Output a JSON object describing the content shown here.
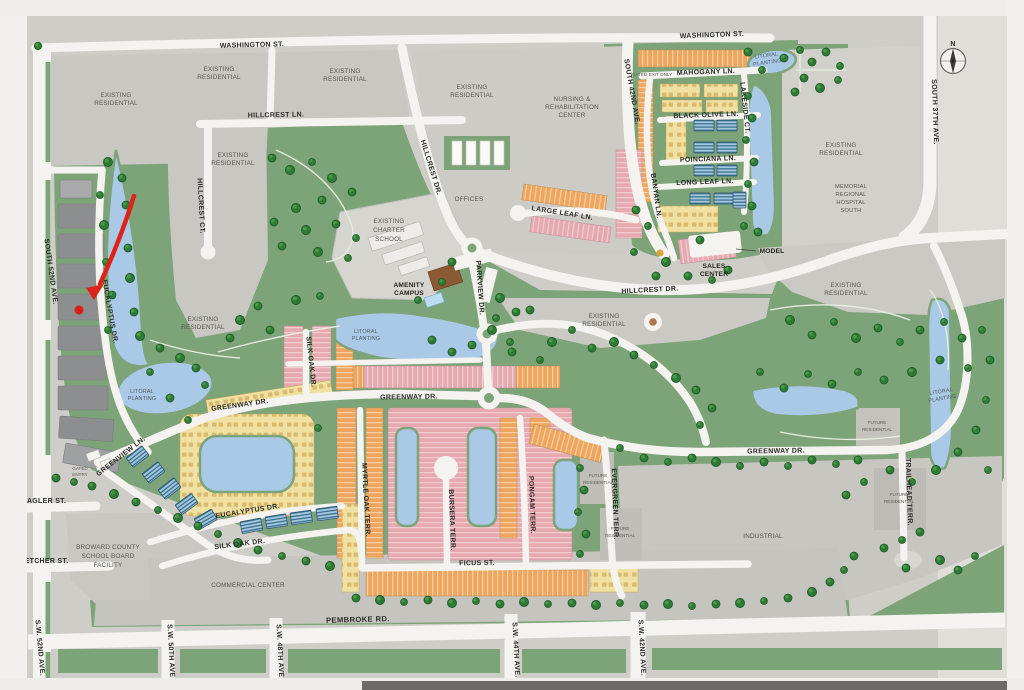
{
  "annotation": {
    "arrow_color": "#dc241b"
  },
  "compass": {
    "north": "N"
  },
  "streets": {
    "washington_st": "WASHINGTON ST.",
    "hillcrest_ln": "HILLCREST LN.",
    "hillcrest_ct": "HILLCREST CT.",
    "hillcrest_dr": "HILLCREST DR.",
    "south_52nd_ave": "SOUTH 52ND AVE.",
    "south_42nd_ave": "SOUTH 42ND AVE.",
    "south_37th_ave": "SOUTH 37TH AVE.",
    "mahogany_ln": "MAHOGANY LN.",
    "black_olive_ln": "BLACK OLIVE LN.",
    "poinciana_ln": "POINCIANA LN.",
    "long_leaf_ln": "LONG LEAF LN.",
    "large_leaf_ln": "LARGE LEAF LN.",
    "lakeside_ct": "LAKESIDE CT.",
    "banyan_ln": "BANYAN LN.",
    "parkview_dr": "PARKVIEW DR.",
    "greenway_dr": "GREENWAY DR.",
    "greenview_ln": "GREENVIEW LN.",
    "silk_oak_dr": "SILK OAK DR.",
    "eucalyptus_dr": "EUCALYPTUS DR.",
    "myrtle_oak_terr": "MYRTLE OAK TERR.",
    "bursera_terr": "BURSERA TERR.",
    "pongam_terr": "PONGAM TERR.",
    "evergreen_terr": "EVERGREEN TERR.",
    "trailhead_terr": "TRAILHEAD TERR.",
    "ficus_st": "FICUS ST.",
    "pembroke_rd": "PEMBROKE RD.",
    "flagler_st": "FLAGLER ST.",
    "fletcher_st": "FLETCHER ST.",
    "sw_52nd_ave": "S.W. 52ND AVE.",
    "sw_50th_ave": "S.W. 50TH AVE.",
    "sw_48th_ave": "S.W. 48TH AVE.",
    "sw_44th_ave": "S.W. 44TH AVE.",
    "sw_42nd_ave": "S.W. 42ND AVE."
  },
  "places": {
    "existing_residential": {
      "l1": "EXISTING",
      "l2": "RESIDENTIAL"
    },
    "nursing_rehab": {
      "l1": "NURSING &",
      "l2": "REHABILITATION",
      "l3": "CENTER"
    },
    "memorial_hospital": {
      "l1": "MEMORIAL",
      "l2": "REGIONAL",
      "l3": "HOSPITAL",
      "l4": "SOUTH"
    },
    "charter_school": {
      "l1": "EXISTING",
      "l2": "CHARTER",
      "l3": "SCHOOL"
    },
    "amenity_campus": {
      "l1": "AMENITY",
      "l2": "CAMPUS"
    },
    "sales_center": {
      "l1": "SALES",
      "l2": "CENTER"
    },
    "model": "MODEL",
    "offices": "OFFICES",
    "litoral_planting": {
      "l1": "LITORAL",
      "l2": "PLANTING"
    },
    "broward_school_board": {
      "l1": "BROWARD COUNTY",
      "l2": "SCHOOL BOARD",
      "l3": "FACILITY"
    },
    "commercial_center": "COMMERCIAL CENTER",
    "industrial": "INDUSTRIAL",
    "future_residential": {
      "l1": "FUTURE",
      "l2": "RESIDENTIAL"
    },
    "gated_exit": "GATED EXIT ONLY",
    "gated_entry": {
      "l1": "GATED",
      "l2": "ENTRY"
    }
  }
}
